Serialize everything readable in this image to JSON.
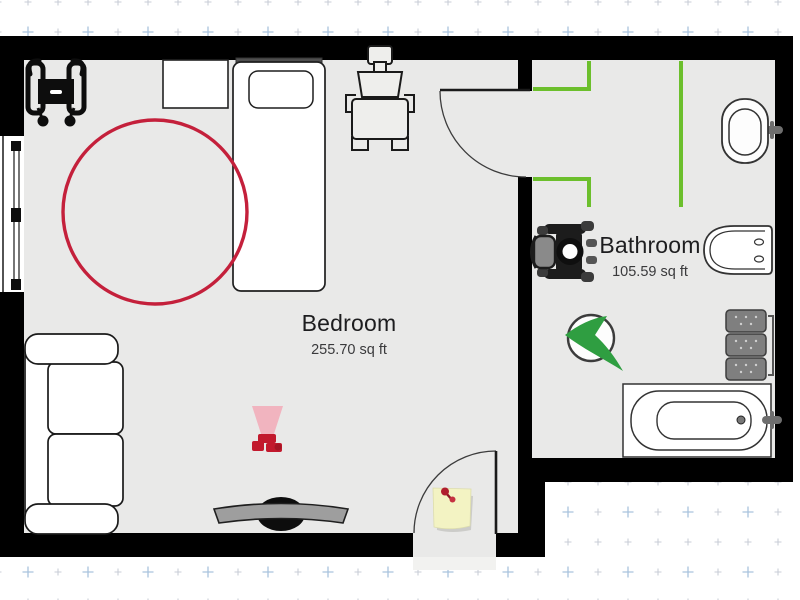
{
  "app": {
    "type": "floor-plan-view"
  },
  "rooms": [
    {
      "name": "Bedroom",
      "area": "255.70 sq ft"
    },
    {
      "name": "Bathroom",
      "area": "105.59 sq ft"
    }
  ],
  "furniture": {
    "bedroom": [
      "rollator-walker",
      "nightstand",
      "single-bed",
      "wheelchair",
      "round-rug",
      "loveseat-sofa",
      "security-camera",
      "tv-on-stand",
      "sticky-note"
    ],
    "bathroom": [
      "wheelchair",
      "toilet",
      "sink",
      "grab-rails",
      "brand-logo",
      "storage-shelves",
      "bathtub"
    ]
  },
  "openings": [
    "window-left-wall",
    "interior-door-bedroom-bathroom",
    "exterior-door-bottom"
  ],
  "colors": {
    "wall": "#000000",
    "floor": "#e9e9e8",
    "rug_red": "#c4203b",
    "rail_green": "#6cbf2c",
    "logo_green": "#2f9e41",
    "camera_red": "#c2192d",
    "note_yellow": "#f3f3c3",
    "headboard_gray": "#4f4f4f",
    "tv_screen_gray": "#9e9e9e",
    "shelf_gray": "#7f7f7f",
    "grid_mark": "#c9ced7",
    "grid_accent": "#a9c3dd"
  }
}
